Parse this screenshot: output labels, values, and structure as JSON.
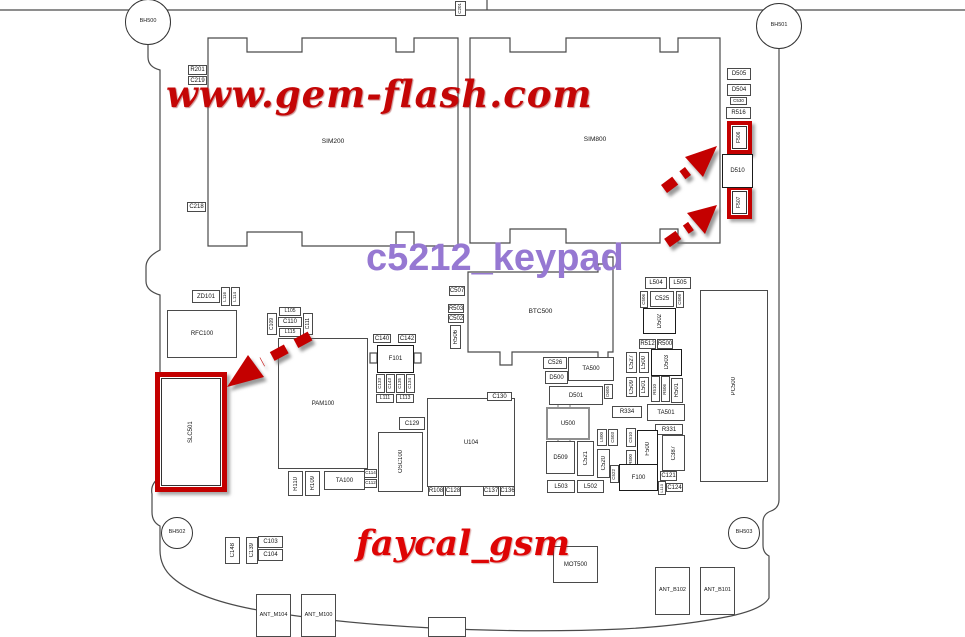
{
  "watermarks": {
    "gem_flash": "www.gem-flash.com",
    "keypad": "c5212_keypad",
    "faycal": "faycal_gsm"
  },
  "colors": {
    "watermark_red": "#c40606",
    "keypad_purple": "#9678d2",
    "highlight_red": "#c40000",
    "outline": "#4a4a4a"
  },
  "holes": [
    {
      "label": "BH500",
      "cx": 148,
      "cy": 22,
      "r": 23
    },
    {
      "label": "BH501",
      "cx": 779,
      "cy": 26,
      "r": 23
    },
    {
      "label": "BH502",
      "cx": 177,
      "cy": 533,
      "r": 16
    },
    {
      "label": "BH503",
      "cx": 744,
      "cy": 533,
      "r": 16
    }
  ],
  "components": [
    {
      "label": "SIM200",
      "x": 208,
      "y": 38,
      "w": 250,
      "h": 208,
      "cls": "naked",
      "fs": 6.5
    },
    {
      "label": "SIM800",
      "x": 470,
      "y": 38,
      "w": 250,
      "h": 205,
      "cls": "naked",
      "fs": 6.5
    },
    {
      "label": "BTC500",
      "x": 468,
      "y": 272,
      "w": 145,
      "h": 80,
      "cls": "naked",
      "fs": 6.5
    },
    {
      "label": "RFC100",
      "x": 167,
      "y": 310,
      "w": 70,
      "h": 48
    },
    {
      "label": "PAM100",
      "x": 278,
      "y": 338,
      "w": 90,
      "h": 131
    },
    {
      "label": "U104",
      "x": 427,
      "y": 398,
      "w": 88,
      "h": 89
    },
    {
      "label": "OSC100",
      "x": 378,
      "y": 432,
      "w": 45,
      "h": 60,
      "v": true
    },
    {
      "label": "U500",
      "x": 546,
      "y": 407,
      "w": 44,
      "h": 33,
      "cls": "gray"
    },
    {
      "label": "PC500",
      "x": 700,
      "y": 290,
      "w": 68,
      "h": 192,
      "v": true
    },
    {
      "label": "MOT500",
      "x": 553,
      "y": 546,
      "w": 45,
      "h": 37
    },
    {
      "label": "ANT_M104",
      "x": 256,
      "y": 594,
      "w": 35,
      "h": 43,
      "fs": 5.5
    },
    {
      "label": "ANT_M100",
      "x": 301,
      "y": 594,
      "w": 35,
      "h": 43,
      "fs": 5.5
    },
    {
      "label": "ANT_B102",
      "x": 655,
      "y": 567,
      "w": 35,
      "h": 48,
      "fs": 5.5
    },
    {
      "label": "ANT_B101",
      "x": 700,
      "y": 567,
      "w": 35,
      "h": 48,
      "fs": 5.5
    },
    {
      "label": "SLC501",
      "x": 155,
      "y": 372,
      "w": 72,
      "h": 120,
      "v": true,
      "cls": "red red5"
    },
    {
      "label": "F506",
      "x": 727,
      "y": 121,
      "w": 25,
      "h": 33,
      "v": true,
      "cls": "red",
      "fs": 5
    },
    {
      "label": "F507",
      "x": 727,
      "y": 186,
      "w": 25,
      "h": 33,
      "v": true,
      "cls": "red",
      "fs": 5
    },
    {
      "label": "D510",
      "x": 722,
      "y": 154,
      "w": 31,
      "h": 34,
      "cls": "bold"
    },
    {
      "label": "D505",
      "x": 727,
      "y": 68,
      "w": 24,
      "h": 12
    },
    {
      "label": "D504",
      "x": 727,
      "y": 84,
      "w": 24,
      "h": 12
    },
    {
      "label": "C530",
      "x": 730,
      "y": 97,
      "w": 17,
      "h": 8,
      "fs": 4.5
    },
    {
      "label": "R516",
      "x": 726,
      "y": 107,
      "w": 25,
      "h": 12
    },
    {
      "label": "R201",
      "x": 188,
      "y": 65,
      "w": 19,
      "h": 10
    },
    {
      "label": "C219",
      "x": 188,
      "y": 76,
      "w": 19,
      "h": 9
    },
    {
      "label": "C218",
      "x": 187,
      "y": 202,
      "w": 19,
      "h": 10
    },
    {
      "label": "C201",
      "x": 455,
      "y": 1,
      "w": 11,
      "h": 15,
      "v": true,
      "fs": 4.5
    },
    {
      "label": "C507",
      "x": 449,
      "y": 286,
      "w": 16,
      "h": 10
    },
    {
      "label": "R503",
      "x": 448,
      "y": 304,
      "w": 16,
      "h": 9
    },
    {
      "label": "C502",
      "x": 448,
      "y": 314,
      "w": 16,
      "h": 9
    },
    {
      "label": "R506",
      "x": 450,
      "y": 325,
      "w": 11,
      "h": 24,
      "v": true
    },
    {
      "label": "ZD101",
      "x": 192,
      "y": 290,
      "w": 28,
      "h": 13
    },
    {
      "label": "L116",
      "x": 221,
      "y": 287,
      "w": 9,
      "h": 19,
      "v": true,
      "fs": 4.5
    },
    {
      "label": "L114",
      "x": 231,
      "y": 287,
      "w": 9,
      "h": 19,
      "v": true,
      "fs": 4.5
    },
    {
      "label": "C109",
      "x": 267,
      "y": 313,
      "w": 10,
      "h": 22,
      "v": true,
      "fs": 5
    },
    {
      "label": "L105",
      "x": 279,
      "y": 307,
      "w": 22,
      "h": 9,
      "fs": 5
    },
    {
      "label": "C110",
      "x": 278,
      "y": 317,
      "w": 24,
      "h": 10
    },
    {
      "label": "L115",
      "x": 279,
      "y": 328,
      "w": 22,
      "h": 9,
      "fs": 5
    },
    {
      "label": "C111",
      "x": 303,
      "y": 313,
      "w": 10,
      "h": 22,
      "v": true,
      "fs": 5
    },
    {
      "label": "C140",
      "x": 373,
      "y": 334,
      "w": 18,
      "h": 9
    },
    {
      "label": "C142",
      "x": 398,
      "y": 334,
      "w": 18,
      "h": 9
    },
    {
      "label": "F101",
      "x": 377,
      "y": 345,
      "w": 37,
      "h": 28,
      "cls": "bold"
    },
    {
      "label": "C133",
      "x": 376,
      "y": 374,
      "w": 9,
      "h": 19,
      "v": true,
      "fs": 4.5
    },
    {
      "label": "C143",
      "x": 386,
      "y": 374,
      "w": 9,
      "h": 19,
      "v": true,
      "fs": 4.5
    },
    {
      "label": "C135",
      "x": 396,
      "y": 374,
      "w": 9,
      "h": 19,
      "v": true,
      "fs": 4.5
    },
    {
      "label": "C134",
      "x": 406,
      "y": 374,
      "w": 9,
      "h": 19,
      "v": true,
      "fs": 4.5
    },
    {
      "label": "L111",
      "x": 376,
      "y": 394,
      "w": 18,
      "h": 9,
      "fs": 5
    },
    {
      "label": "L113",
      "x": 396,
      "y": 394,
      "w": 18,
      "h": 9,
      "fs": 5
    },
    {
      "label": "C130",
      "x": 487,
      "y": 392,
      "w": 25,
      "h": 9
    },
    {
      "label": "C129",
      "x": 399,
      "y": 417,
      "w": 26,
      "h": 13
    },
    {
      "label": "R110",
      "x": 288,
      "y": 471,
      "w": 15,
      "h": 25,
      "v": true
    },
    {
      "label": "R109",
      "x": 305,
      "y": 471,
      "w": 15,
      "h": 25,
      "v": true
    },
    {
      "label": "TA100",
      "x": 324,
      "y": 471,
      "w": 41,
      "h": 19
    },
    {
      "label": "C114",
      "x": 364,
      "y": 469,
      "w": 13,
      "h": 9,
      "fs": 4.5
    },
    {
      "label": "C112",
      "x": 364,
      "y": 479,
      "w": 13,
      "h": 9,
      "fs": 4.5
    },
    {
      "label": "R108",
      "x": 428,
      "y": 486,
      "w": 16,
      "h": 10
    },
    {
      "label": "C128",
      "x": 445,
      "y": 486,
      "w": 16,
      "h": 10
    },
    {
      "label": "C137",
      "x": 483,
      "y": 486,
      "w": 16,
      "h": 10
    },
    {
      "label": "C136",
      "x": 500,
      "y": 486,
      "w": 15,
      "h": 10
    },
    {
      "label": "C526",
      "x": 543,
      "y": 357,
      "w": 24,
      "h": 12
    },
    {
      "label": "TA500",
      "x": 568,
      "y": 357,
      "w": 46,
      "h": 24
    },
    {
      "label": "D500",
      "x": 545,
      "y": 371,
      "w": 23,
      "h": 13
    },
    {
      "label": "D501",
      "x": 549,
      "y": 386,
      "w": 54,
      "h": 19
    },
    {
      "label": "D605",
      "x": 604,
      "y": 384,
      "w": 9,
      "h": 15,
      "v": true,
      "fs": 4.5
    },
    {
      "label": "L504",
      "x": 645,
      "y": 277,
      "w": 22,
      "h": 12
    },
    {
      "label": "L505",
      "x": 669,
      "y": 277,
      "w": 22,
      "h": 12
    },
    {
      "label": "C506",
      "x": 640,
      "y": 291,
      "w": 8,
      "h": 17,
      "v": true,
      "fs": 4.5
    },
    {
      "label": "C525",
      "x": 650,
      "y": 291,
      "w": 24,
      "h": 16
    },
    {
      "label": "C508",
      "x": 676,
      "y": 291,
      "w": 8,
      "h": 17,
      "v": true,
      "fs": 4.5
    },
    {
      "label": "D502",
      "x": 643,
      "y": 308,
      "w": 33,
      "h": 26,
      "v": true,
      "cls": "bold"
    },
    {
      "label": "R512",
      "x": 639,
      "y": 339,
      "w": 17,
      "h": 10
    },
    {
      "label": "R500",
      "x": 657,
      "y": 339,
      "w": 16,
      "h": 10
    },
    {
      "label": "C527",
      "x": 626,
      "y": 352,
      "w": 11,
      "h": 21,
      "v": true
    },
    {
      "label": "L500",
      "x": 639,
      "y": 352,
      "w": 10,
      "h": 21,
      "v": true
    },
    {
      "label": "D503",
      "x": 651,
      "y": 349,
      "w": 31,
      "h": 27,
      "v": true,
      "cls": "bold"
    },
    {
      "label": "C509",
      "x": 626,
      "y": 377,
      "w": 11,
      "h": 20,
      "v": true
    },
    {
      "label": "L501",
      "x": 639,
      "y": 377,
      "w": 10,
      "h": 20,
      "v": true
    },
    {
      "label": "R510",
      "x": 651,
      "y": 376,
      "w": 9,
      "h": 26,
      "v": true,
      "fs": 4.5
    },
    {
      "label": "R506",
      "x": 661,
      "y": 376,
      "w": 9,
      "h": 26,
      "v": true,
      "fs": 4.5
    },
    {
      "label": "R501",
      "x": 671,
      "y": 378,
      "w": 12,
      "h": 25,
      "v": true
    },
    {
      "label": "R334",
      "x": 612,
      "y": 406,
      "w": 30,
      "h": 12
    },
    {
      "label": "TA501",
      "x": 647,
      "y": 404,
      "w": 38,
      "h": 17
    },
    {
      "label": "R331",
      "x": 655,
      "y": 424,
      "w": 28,
      "h": 11
    },
    {
      "label": "L500",
      "x": 597,
      "y": 429,
      "w": 10,
      "h": 17,
      "v": true,
      "fs": 4.5
    },
    {
      "label": "C503",
      "x": 608,
      "y": 429,
      "w": 10,
      "h": 17,
      "v": true,
      "fs": 4.5
    },
    {
      "label": "C510",
      "x": 626,
      "y": 428,
      "w": 10,
      "h": 19,
      "v": true,
      "fs": 4.5
    },
    {
      "label": "R500",
      "x": 626,
      "y": 450,
      "w": 10,
      "h": 18,
      "v": true,
      "fs": 4.5
    },
    {
      "label": "F500",
      "x": 637,
      "y": 430,
      "w": 21,
      "h": 38,
      "v": true,
      "cls": "bold"
    },
    {
      "label": "C387",
      "x": 662,
      "y": 435,
      "w": 23,
      "h": 36,
      "v": true
    },
    {
      "label": "D509",
      "x": 546,
      "y": 441,
      "w": 29,
      "h": 33
    },
    {
      "label": "C521",
      "x": 577,
      "y": 441,
      "w": 17,
      "h": 35,
      "v": true
    },
    {
      "label": "C520",
      "x": 597,
      "y": 449,
      "w": 13,
      "h": 29,
      "v": true
    },
    {
      "label": "L503",
      "x": 547,
      "y": 480,
      "w": 28,
      "h": 13
    },
    {
      "label": "L502",
      "x": 577,
      "y": 480,
      "w": 27,
      "h": 13
    },
    {
      "label": "C522",
      "x": 610,
      "y": 465,
      "w": 9,
      "h": 18,
      "v": true,
      "fs": 4.5
    },
    {
      "label": "F100",
      "x": 619,
      "y": 464,
      "w": 39,
      "h": 27,
      "cls": "bold"
    },
    {
      "label": "C121",
      "x": 660,
      "y": 471,
      "w": 17,
      "h": 10
    },
    {
      "label": "C124",
      "x": 666,
      "y": 483,
      "w": 17,
      "h": 9
    },
    {
      "label": "L110",
      "x": 658,
      "y": 481,
      "w": 8,
      "h": 14,
      "v": true,
      "fs": 4
    },
    {
      "label": "C148",
      "x": 225,
      "y": 537,
      "w": 15,
      "h": 27,
      "v": true
    },
    {
      "label": "C139",
      "x": 246,
      "y": 537,
      "w": 12,
      "h": 27,
      "v": true
    },
    {
      "label": "C103",
      "x": 258,
      "y": 536,
      "w": 25,
      "h": 12
    },
    {
      "label": "C104",
      "x": 258,
      "y": 549,
      "w": 25,
      "h": 12
    },
    {
      "label": "",
      "x": 428,
      "y": 617,
      "w": 38,
      "h": 20
    }
  ]
}
